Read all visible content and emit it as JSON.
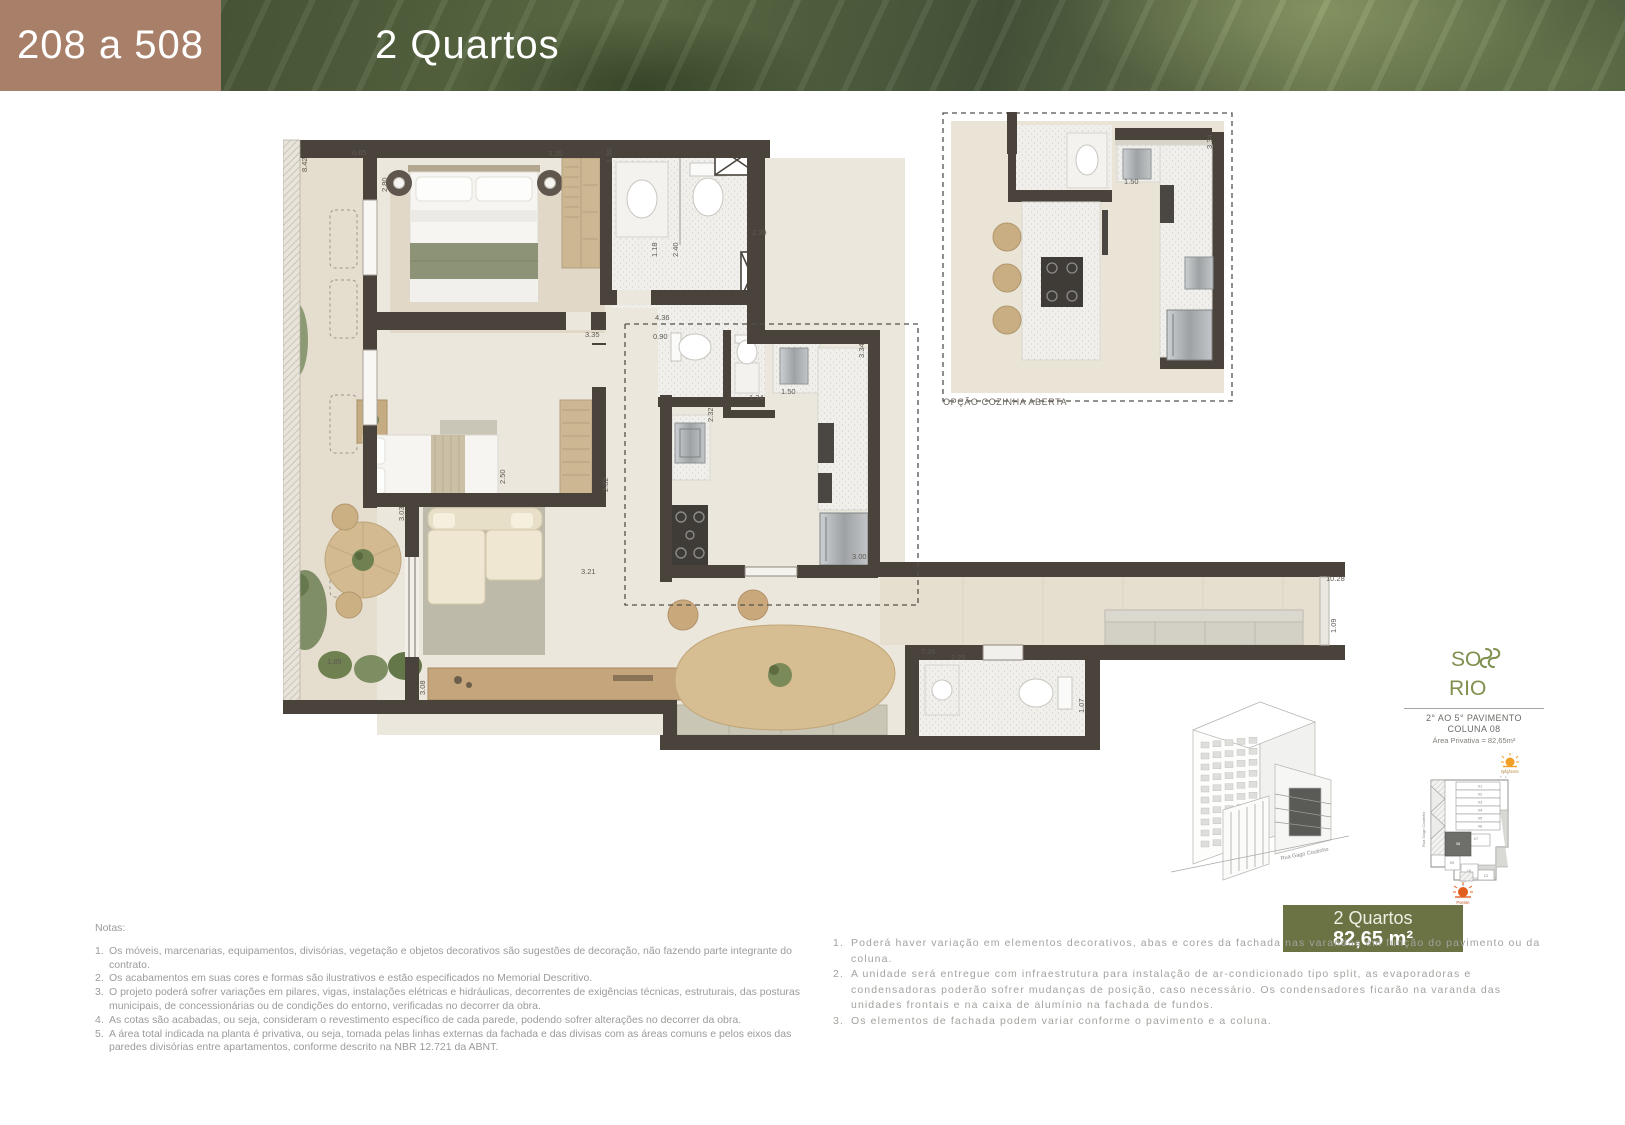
{
  "header": {
    "unit_range": "208 a 508",
    "type_label": "2 Quartos",
    "brown_color": "#a87f68",
    "leaf_green_color": "#55644a"
  },
  "floorplan": {
    "inset_caption": "OPÇÃO COZINHA ABERTA",
    "wall_color": "#4a433c",
    "dimensions": [
      {
        "t": "8.42",
        "x": 24,
        "y": 67,
        "r": true
      },
      {
        "t": "0.65",
        "x": 69,
        "y": 50
      },
      {
        "t": "2.80",
        "x": 104,
        "y": 87,
        "r": true
      },
      {
        "t": "3.35",
        "x": 265,
        "y": 51
      },
      {
        "t": "1.30",
        "x": 329,
        "y": 58,
        "r": true
      },
      {
        "t": "2.39",
        "x": 469,
        "y": 130
      },
      {
        "t": "1.18",
        "x": 374,
        "y": 152,
        "r": true
      },
      {
        "t": "2.40",
        "x": 395,
        "y": 152,
        "r": true
      },
      {
        "t": "4.36",
        "x": 372,
        "y": 215
      },
      {
        "t": "3.35",
        "x": 302,
        "y": 232
      },
      {
        "t": "0.90",
        "x": 370,
        "y": 234
      },
      {
        "t": "1.34",
        "x": 466,
        "y": 295
      },
      {
        "t": "1.50",
        "x": 498,
        "y": 289
      },
      {
        "t": "3.34",
        "x": 581,
        "y": 253,
        "r": true
      },
      {
        "t": "2.32",
        "x": 430,
        "y": 317,
        "r": true
      },
      {
        "t": "2.50",
        "x": 222,
        "y": 379,
        "r": true
      },
      {
        "t": "2.82",
        "x": 325,
        "y": 387,
        "r": true
      },
      {
        "t": "3.03",
        "x": 121,
        "y": 416,
        "r": true
      },
      {
        "t": "3.21",
        "x": 298,
        "y": 469
      },
      {
        "t": "3.00",
        "x": 569,
        "y": 454
      },
      {
        "t": "1.85",
        "x": 44,
        "y": 559
      },
      {
        "t": "3.08",
        "x": 142,
        "y": 590,
        "r": true
      },
      {
        "t": "7.26",
        "x": 638,
        "y": 549
      },
      {
        "t": "2.25",
        "x": 668,
        "y": 555
      },
      {
        "t": "1.07",
        "x": 801,
        "y": 608,
        "r": true
      },
      {
        "t": "10.28",
        "x": 1043,
        "y": 476
      },
      {
        "t": "1.09",
        "x": 1053,
        "y": 528,
        "r": true
      },
      {
        "t": "1.50",
        "x": 841,
        "y": 79
      },
      {
        "t": "3.34",
        "x": 929,
        "y": 44,
        "r": true
      }
    ]
  },
  "logo": {
    "line1": "SO",
    "line2": "RIO",
    "color": "#7f8f4d",
    "pavement": "2° AO 5° PAVIMENTO",
    "column": "COLUNA 08",
    "private_area": "Área Privativa = 82,65m²"
  },
  "building": {
    "street": "Rua Gago Coutinho"
  },
  "keyplan": {
    "street": "Rua Gago Coutinho",
    "sun_rise_label": "Nascente",
    "sun_set_label": "Poente",
    "sun_rise_color": "#f0a028",
    "sun_set_color": "#e2601f",
    "highlight_unit": "08",
    "units": [
      {
        "label": "01",
        "x": 64,
        "y": 35.5
      },
      {
        "label": "02",
        "x": 64,
        "y": 43.5
      },
      {
        "label": "03",
        "x": 64,
        "y": 51.5
      },
      {
        "label": "04",
        "x": 64,
        "y": 59.5
      },
      {
        "label": "05",
        "x": 64,
        "y": 67.5
      },
      {
        "label": "06",
        "x": 64,
        "y": 75.5
      },
      {
        "label": "07",
        "x": 60,
        "y": 88
      },
      {
        "label": "08",
        "x": 42,
        "y": 93,
        "dark": true
      },
      {
        "label": "09",
        "x": 36,
        "y": 112
      },
      {
        "label": "10",
        "x": 53,
        "y": 120
      },
      {
        "label": "12",
        "x": 70,
        "y": 125
      }
    ]
  },
  "badge": {
    "line1": "2 Quartos",
    "line2": "82,65 m²",
    "color": "#6b7243"
  },
  "notes_left": {
    "title": "Notas:",
    "items": [
      "Os móveis, marcenarias, equipamentos, divisórias, vegetação e objetos decorativos são sugestões de decoração, não fazendo parte integrante do contrato.",
      "Os acabamentos em suas cores e formas são ilustrativos e estão especificados no Memorial Descritivo.",
      "O projeto poderá sofrer variações em pilares, vigas, instalações elétricas e hidráulicas, decorrentes de exigências técnicas, estruturais, das posturas municipais, de concessionárias ou de condições do entorno, verificadas no decorrer da obra.",
      "As cotas são acabadas, ou seja, consideram o revestimento específico de cada parede, podendo sofrer alterações no decorrer da obra.",
      "A área total indicada na planta é privativa, ou seja, tomada pelas linhas externas da fachada e das divisas com as áreas comuns e pelos eixos das paredes divisórias entre apartamentos, conforme descrito na NBR 12.721 da ABNT."
    ]
  },
  "notes_right": {
    "items": [
      "Poderá haver variação em elementos decorativos, abas e cores da fachada nas varandas em função do pavimento ou da coluna.",
      "A unidade será entregue com infraestrutura para instalação de ar-condicionado tipo split, as evaporadoras e condensadoras poderão sofrer mudanças de posição, caso necessário. Os condensadores ficarão na varanda das unidades frontais e na caixa de alumínio na fachada de fundos.",
      "Os elementos de fachada podem variar conforme o pavimento e a coluna."
    ]
  }
}
